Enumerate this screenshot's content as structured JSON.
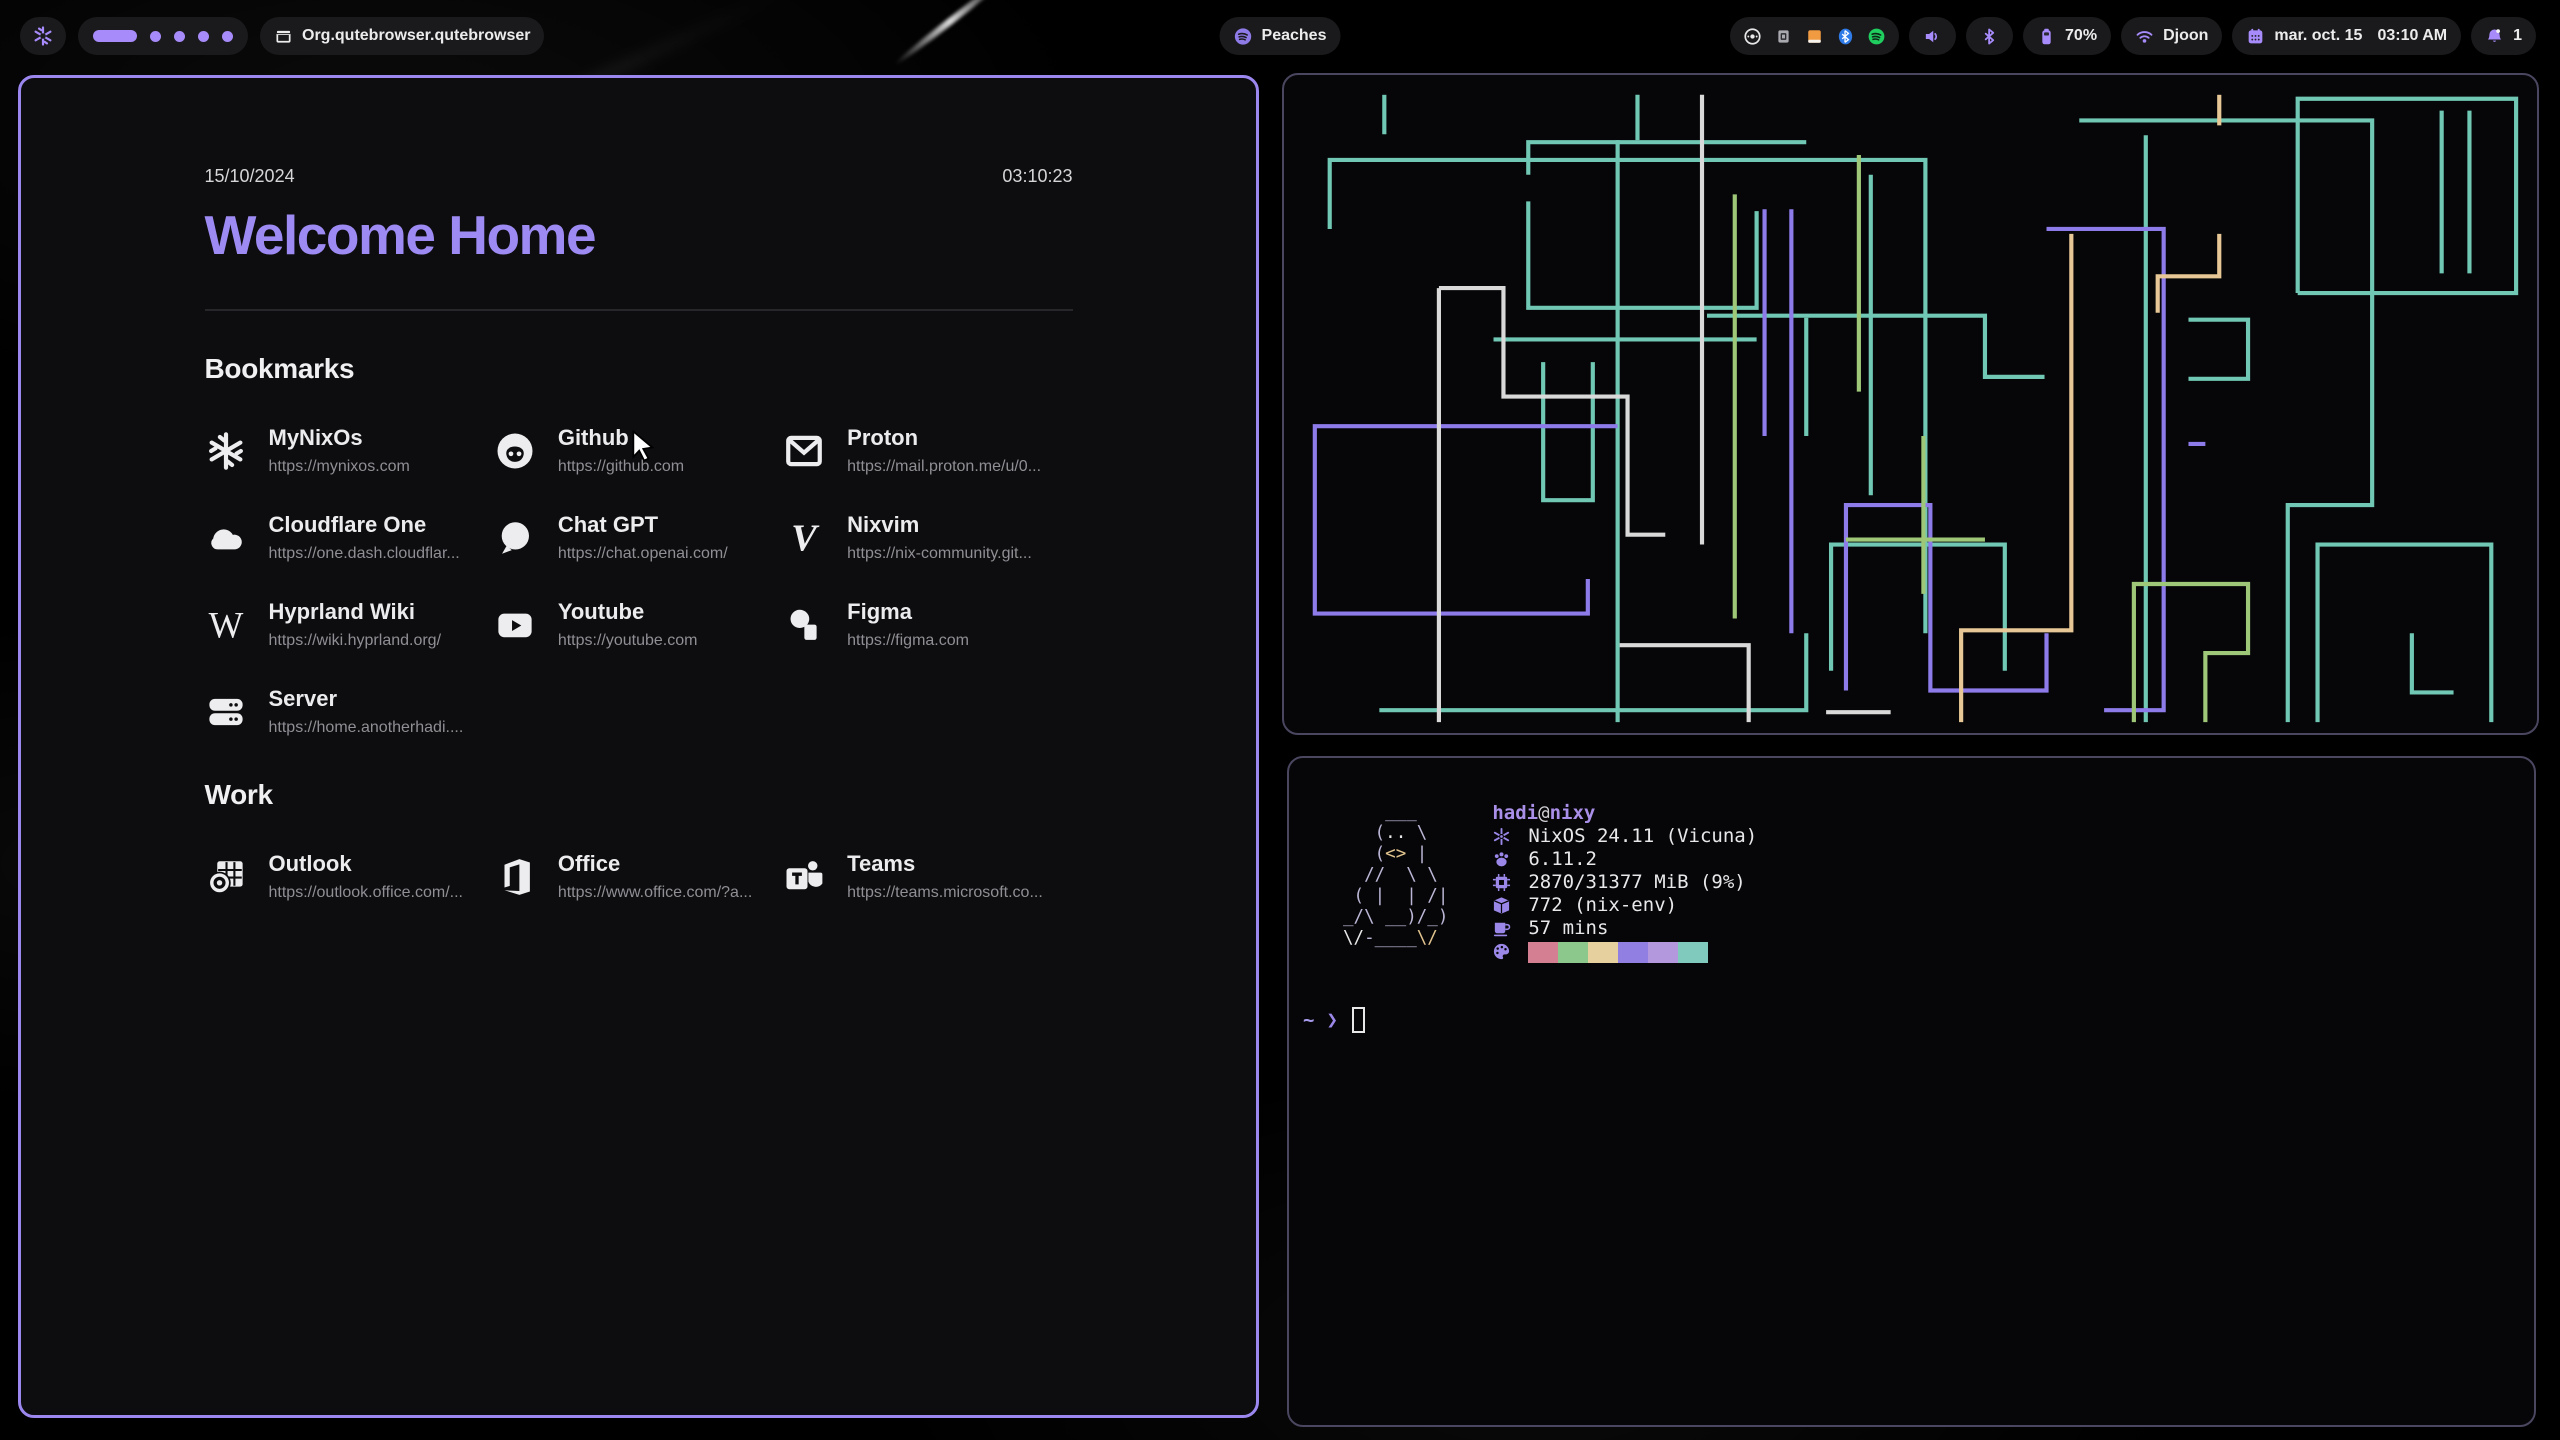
{
  "colors": {
    "accent": "#a78bfa",
    "title_purple": "#9d8bf3",
    "window_border_active": "#9c87ef",
    "window_border_inactive": "#4b4660",
    "url_gray": "#8f8f94",
    "tray_orange": "#f09a42",
    "tray_blue": "#2f7be8",
    "tray_green": "#1fce5f"
  },
  "bar": {
    "logo_icon": "nixos-snowflake",
    "workspaces": {
      "count": 5,
      "active": 1
    },
    "window_title": "Org.qutebrowser.qutebrowser",
    "now_playing": {
      "icon": "spotify",
      "label": "Peaches"
    },
    "tray_icons": [
      "disc-icon",
      "applet-icon",
      "files-icon",
      "bluetooth-icon",
      "spotify-icon"
    ],
    "battery": {
      "icon": "battery",
      "label": "70%"
    },
    "network": {
      "icon": "wifi",
      "label": "Djoon"
    },
    "clock": {
      "icon": "calendar",
      "date": "mar. oct. 15",
      "time": "03:10 AM"
    },
    "notifications": {
      "icon": "bell",
      "count": "1"
    }
  },
  "startpage": {
    "date": "15/10/2024",
    "time": "03:10:23",
    "title": "Welcome Home",
    "sections": [
      {
        "heading": "Bookmarks",
        "links": [
          {
            "name": "MyNixOs",
            "url": "https://mynixos.com",
            "icon": "nixos"
          },
          {
            "name": "Github",
            "url": "https://github.com",
            "icon": "github"
          },
          {
            "name": "Proton",
            "url": "https://mail.proton.me/u/0...",
            "icon": "mail"
          },
          {
            "name": "Cloudflare One",
            "url": "https://one.dash.cloudflar...",
            "icon": "cloud"
          },
          {
            "name": "Chat GPT",
            "url": "https://chat.openai.com/",
            "icon": "chat"
          },
          {
            "name": "Nixvim",
            "url": "https://nix-community.git...",
            "icon": "nixvim"
          },
          {
            "name": "Hyprland Wiki",
            "url": "https://wiki.hyprland.org/",
            "icon": "wiki"
          },
          {
            "name": "Youtube",
            "url": "https://youtube.com",
            "icon": "youtube"
          },
          {
            "name": "Figma",
            "url": "https://figma.com",
            "icon": "figma"
          },
          {
            "name": "Server",
            "url": "https://home.anotherhadi....",
            "icon": "server"
          }
        ]
      },
      {
        "heading": "Work",
        "links": [
          {
            "name": "Outlook",
            "url": "https://outlook.office.com/...",
            "icon": "outlook"
          },
          {
            "name": "Office",
            "url": "https://www.office.com/?a...",
            "icon": "office"
          },
          {
            "name": "Teams",
            "url": "https://teams.microsoft.co...",
            "icon": "teams"
          }
        ]
      }
    ]
  },
  "fetch": {
    "user": "hadi",
    "at": "@",
    "host": "nixy",
    "rows": [
      {
        "icon": "snow",
        "text": "NixOS 24.11 (Vicuna)"
      },
      {
        "icon": "kernel",
        "text": "6.11.2"
      },
      {
        "icon": "mem",
        "text": "2870/31377 MiB (9%)"
      },
      {
        "icon": "pkg",
        "text": "772 (nix-env)"
      },
      {
        "icon": "cup",
        "text": "57 mins"
      }
    ],
    "palette_icon": "palette",
    "palette": [
      "#d57f93",
      "#8cc88c",
      "#e5d09e",
      "#9180e1",
      "#b498dd",
      "#80c9bd"
    ],
    "ascii": [
      [
        [
          "l",
          "    ___"
        ]
      ],
      [
        [
          "l",
          "   ("
        ],
        [
          "w",
          ".."
        ],
        [
          "l",
          " \\"
        ]
      ],
      [
        [
          "l",
          "   ("
        ],
        [
          "t",
          "<>"
        ],
        [
          "l",
          " |"
        ]
      ],
      [
        [
          "l",
          "  //  \\ \\"
        ]
      ],
      [
        [
          "l",
          " ( |  | /|"
        ]
      ],
      [
        [
          "l",
          "_/\\ __)/_)"
        ]
      ],
      [
        [
          "w",
          "\\/"
        ],
        [
          "l",
          "-____"
        ],
        [
          "t",
          "\\/"
        ]
      ]
    ],
    "prompt": {
      "dir": "~",
      "symbol": "❯"
    }
  },
  "pipes": {
    "colors": {
      "t": "#6fc7b4",
      "p": "#8d7bea",
      "w": "#d9d9d9",
      "g": "#9ec878",
      "s": "#e7c795"
    },
    "stroke_width": 4.2,
    "paths": [
      {
        "c": "t",
        "d": "M40 150 V80 H640 V560"
      },
      {
        "c": "t",
        "d": "M95 14 V54"
      },
      {
        "c": "t",
        "d": "M350 14 V60"
      },
      {
        "c": "t",
        "d": "M330 60 V650"
      },
      {
        "c": "t",
        "d": "M240 122 V230 H470 V132"
      },
      {
        "c": "t",
        "d": "M255 285 V425 H305 V285"
      },
      {
        "c": "t",
        "d": "M795 40 H1090 V430 H1005 V650"
      },
      {
        "c": "t",
        "d": "M862 55 V650"
      },
      {
        "c": "t",
        "d": "M1035 650 V470 H1210 V650"
      },
      {
        "c": "t",
        "d": "M1015 215 V18 H1235 V215 H1015"
      },
      {
        "c": "t",
        "d": "M1160 30 V195"
      },
      {
        "c": "t",
        "d": "M1188 30 V195"
      },
      {
        "c": "t",
        "d": "M420 238 H700 V300 H760"
      },
      {
        "c": "t",
        "d": "M90 638 H520 V560"
      },
      {
        "c": "t",
        "d": "M545 598 V470 H720 V598"
      },
      {
        "c": "t",
        "d": "M1130 560 V620 H1172"
      },
      {
        "c": "t",
        "d": "M240 95 V62 H520"
      },
      {
        "c": "t",
        "d": "M205 262 H470"
      },
      {
        "c": "t",
        "d": "M520 240 V360"
      },
      {
        "c": "t",
        "d": "M585 95 V420"
      },
      {
        "c": "t",
        "d": "M905 242 H965 V302 H905"
      },
      {
        "c": "p",
        "d": "M330 350 H25 V540 H300 V505"
      },
      {
        "c": "p",
        "d": "M478 130 V360"
      },
      {
        "c": "p",
        "d": "M505 130 V560"
      },
      {
        "c": "p",
        "d": "M560 618 V430 H645 V618 H762 V560"
      },
      {
        "c": "p",
        "d": "M762 150 H880 V638 H820"
      },
      {
        "c": "p",
        "d": "M905 368 H922"
      },
      {
        "c": "w",
        "d": "M150 210 V650"
      },
      {
        "c": "w",
        "d": "M150 210 H215 V320 H340 V460 H378"
      },
      {
        "c": "w",
        "d": "M415 14 V470"
      },
      {
        "c": "w",
        "d": "M332 572 H462 V650"
      },
      {
        "c": "w",
        "d": "M540 640 H605"
      },
      {
        "c": "g",
        "d": "M448 115 V545"
      },
      {
        "c": "g",
        "d": "M573 75 V315"
      },
      {
        "c": "g",
        "d": "M638 360 V520"
      },
      {
        "c": "g",
        "d": "M560 465 H700"
      },
      {
        "c": "g",
        "d": "M850 650 V510 H965 V580 H922 V650"
      },
      {
        "c": "s",
        "d": "M936 14 V45"
      },
      {
        "c": "s",
        "d": "M874 235 V198 H936 V155"
      },
      {
        "c": "s",
        "d": "M787 155 V557 H676 V650"
      }
    ]
  }
}
